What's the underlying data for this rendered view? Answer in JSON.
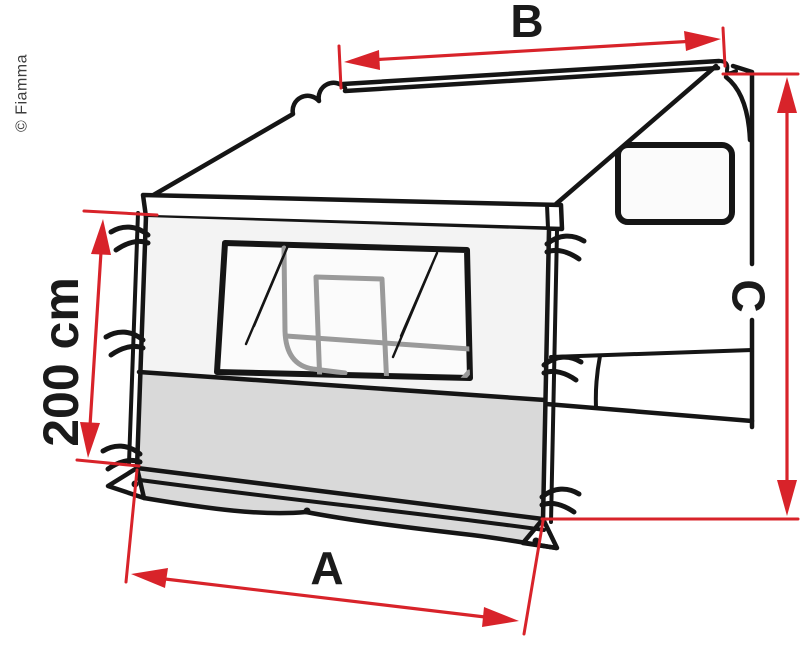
{
  "page": {
    "background": "#ffffff",
    "copyright": "© Fiamma"
  },
  "diagram": {
    "title": "Awning side panel dimension diagram",
    "labels": {
      "panel_width": "A",
      "awning_length": "B",
      "mount_height": "C",
      "panel_height": "200 cm"
    },
    "colors": {
      "dimension_red": "#d8232a",
      "line_black": "#151515",
      "sketch_gray": "#9a9a9a",
      "panel_fill": "#f3f3f3",
      "skirt_fill": "#d9d9d9"
    }
  }
}
